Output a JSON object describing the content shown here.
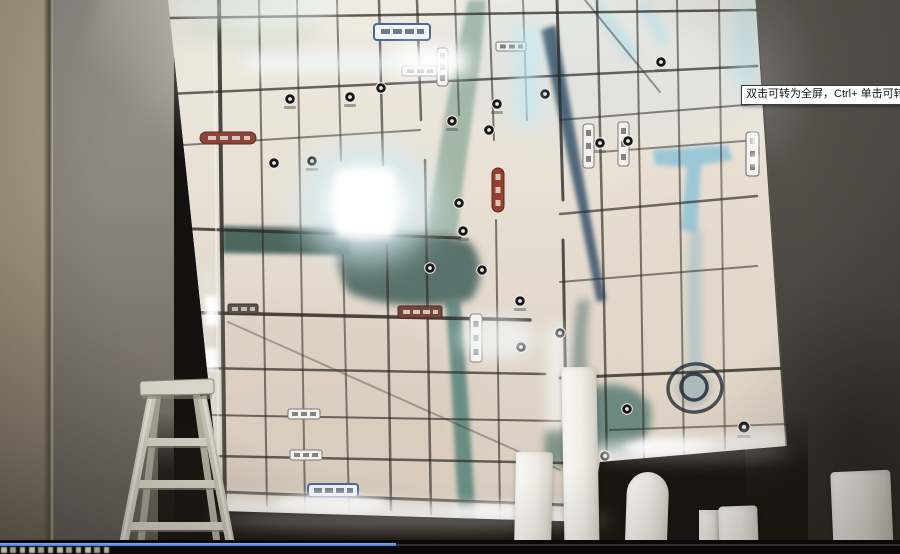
{
  "scene": {
    "subject": "Illuminated city location map wall photographed in an unfinished showroom",
    "foreground_objects": [
      "aluminum-step-ladder",
      "white-foam-columns"
    ],
    "map_features": [
      "road-grid",
      "rivers",
      "poi-markers",
      "road-name-badges",
      "hand-drawn-circle-annotation",
      "led-edge-glow"
    ]
  },
  "tooltip": {
    "text": "双击可转为全屏，Ctrl+ 单击可转为"
  },
  "player_bar": {
    "progress_fraction": 0.44,
    "progress_color": "#3f7dd4",
    "bar_color": "#0a0808"
  },
  "palette": {
    "map_paper": "#e6dfd4",
    "led_glow": "#f2fbff",
    "river_teal": "#4e7d74",
    "river_navy": "#2c4a63",
    "river_light_blue": "#8fc3d8",
    "road": "#2e2a26",
    "left_wall_tan": "#a3977f",
    "left_wall_marble": "#8d877f",
    "right_wall": "#4b463f"
  }
}
